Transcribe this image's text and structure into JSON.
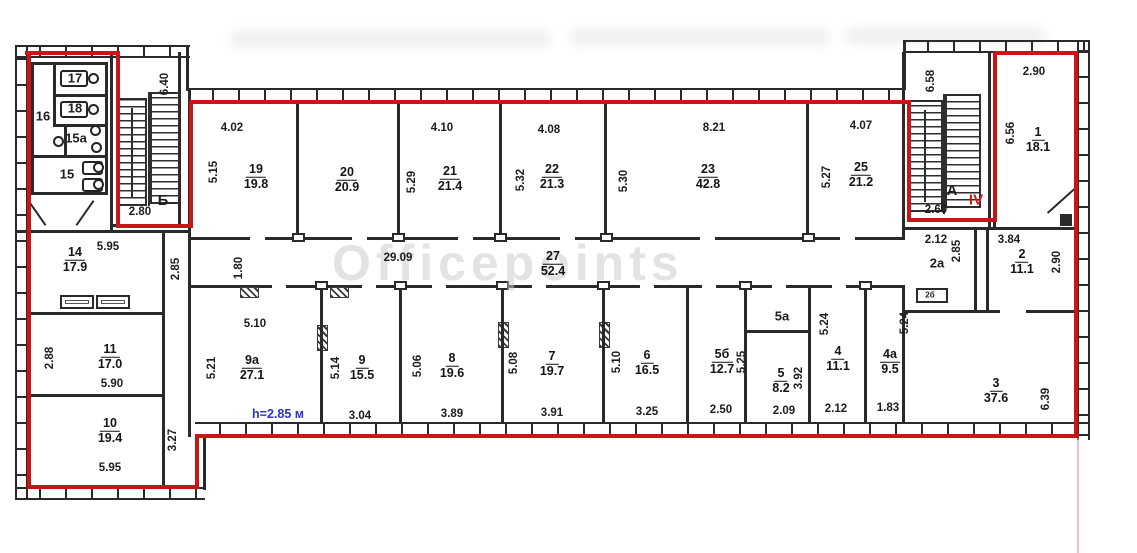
{
  "watermark": "Officepoints",
  "colors": {
    "boundary": "#c81616",
    "wall": "#2a2a2a",
    "height_note": "#2d35c0",
    "section_mark": "#cc1d1d"
  },
  "frac_labels": [
    {
      "num": "19",
      "area": "19.8",
      "x": 256,
      "y": 177
    },
    {
      "num": "20",
      "area": "20.9",
      "x": 347,
      "y": 180
    },
    {
      "num": "21",
      "area": "21.4",
      "x": 450,
      "y": 179
    },
    {
      "num": "22",
      "area": "21.3",
      "x": 552,
      "y": 177
    },
    {
      "num": "23",
      "area": "42.8",
      "x": 708,
      "y": 177
    },
    {
      "num": "25",
      "area": "21.2",
      "x": 861,
      "y": 175
    },
    {
      "num": "27",
      "area": "52.4",
      "x": 553,
      "y": 264
    },
    {
      "num": "9а",
      "area": "27.1",
      "x": 252,
      "y": 368
    },
    {
      "num": "9",
      "area": "15.5",
      "x": 362,
      "y": 368
    },
    {
      "num": "8",
      "area": "19.6",
      "x": 452,
      "y": 366
    },
    {
      "num": "7",
      "area": "19.7",
      "x": 552,
      "y": 364
    },
    {
      "num": "6",
      "area": "16.5",
      "x": 647,
      "y": 363
    },
    {
      "num": "5б",
      "area": "12.7",
      "x": 722,
      "y": 362
    },
    {
      "num": "5",
      "area": "8.2",
      "x": 781,
      "y": 381
    },
    {
      "num": "4",
      "area": "11.1",
      "x": 838,
      "y": 359
    },
    {
      "num": "4а",
      "area": "9.5",
      "x": 890,
      "y": 362
    },
    {
      "num": "1",
      "area": "18.1",
      "x": 1038,
      "y": 140
    },
    {
      "num": "2",
      "area": "11.1",
      "x": 1022,
      "y": 262
    },
    {
      "num": "3",
      "area": "37.6",
      "x": 996,
      "y": 391
    },
    {
      "num": "14",
      "area": "17.9",
      "x": 75,
      "y": 260
    },
    {
      "num": "11",
      "area": "17.0",
      "x": 110,
      "y": 357
    },
    {
      "num": "10",
      "area": "19.4",
      "x": 110,
      "y": 431
    }
  ],
  "text_labels": [
    {
      "t": "4.02",
      "x": 232,
      "y": 128,
      "cls": ""
    },
    {
      "t": "4.10",
      "x": 442,
      "y": 128,
      "cls": ""
    },
    {
      "t": "4.08",
      "x": 549,
      "y": 130,
      "cls": ""
    },
    {
      "t": "8.21",
      "x": 714,
      "y": 128,
      "cls": ""
    },
    {
      "t": "4.07",
      "x": 861,
      "y": 126,
      "cls": ""
    },
    {
      "t": "2.90",
      "x": 1034,
      "y": 72,
      "cls": ""
    },
    {
      "t": "5.15",
      "x": 214,
      "y": 172,
      "cls": "rot"
    },
    {
      "t": "5.29",
      "x": 412,
      "y": 182,
      "cls": "rot"
    },
    {
      "t": "5.32",
      "x": 521,
      "y": 180,
      "cls": "rot"
    },
    {
      "t": "5.30",
      "x": 624,
      "y": 181,
      "cls": "rot"
    },
    {
      "t": "5.27",
      "x": 827,
      "y": 177,
      "cls": "rot"
    },
    {
      "t": "6.58",
      "x": 931,
      "y": 81,
      "cls": "rot"
    },
    {
      "t": "6.56",
      "x": 1011,
      "y": 133,
      "cls": "rot"
    },
    {
      "t": "6.40",
      "x": 165,
      "y": 84,
      "cls": "rot"
    },
    {
      "t": "2.80",
      "x": 140,
      "y": 212,
      "cls": ""
    },
    {
      "t": "2.60",
      "x": 936,
      "y": 210,
      "cls": ""
    },
    {
      "t": "29.09",
      "x": 398,
      "y": 258,
      "cls": ""
    },
    {
      "t": "1.80",
      "x": 239,
      "y": 268,
      "cls": "rot"
    },
    {
      "t": "2.85",
      "x": 176,
      "y": 269,
      "cls": "rot"
    },
    {
      "t": "5.95",
      "x": 108,
      "y": 247,
      "cls": ""
    },
    {
      "t": "2.88",
      "x": 50,
      "y": 358,
      "cls": "rot"
    },
    {
      "t": "5.90",
      "x": 112,
      "y": 384,
      "cls": ""
    },
    {
      "t": "3.27",
      "x": 173,
      "y": 440,
      "cls": "rot"
    },
    {
      "t": "5.95",
      "x": 110,
      "y": 468,
      "cls": ""
    },
    {
      "t": "5.10",
      "x": 255,
      "y": 324,
      "cls": ""
    },
    {
      "t": "5.21",
      "x": 212,
      "y": 368,
      "cls": "rot"
    },
    {
      "t": "5.14",
      "x": 336,
      "y": 368,
      "cls": "rot"
    },
    {
      "t": "3.04",
      "x": 360,
      "y": 416,
      "cls": ""
    },
    {
      "t": "5.06",
      "x": 418,
      "y": 366,
      "cls": "rot"
    },
    {
      "t": "3.89",
      "x": 452,
      "y": 414,
      "cls": ""
    },
    {
      "t": "5.08",
      "x": 514,
      "y": 363,
      "cls": "rot"
    },
    {
      "t": "3.91",
      "x": 552,
      "y": 413,
      "cls": ""
    },
    {
      "t": "5.10",
      "x": 617,
      "y": 362,
      "cls": "rot"
    },
    {
      "t": "3.25",
      "x": 647,
      "y": 412,
      "cls": ""
    },
    {
      "t": "5.25",
      "x": 742,
      "y": 362,
      "cls": "rot"
    },
    {
      "t": "2.50",
      "x": 721,
      "y": 410,
      "cls": ""
    },
    {
      "t": "5а",
      "x": 782,
      "y": 316,
      "cls": "roomtx"
    },
    {
      "t": "3.92",
      "x": 799,
      "y": 378,
      "cls": "rot"
    },
    {
      "t": "2.09",
      "x": 784,
      "y": 411,
      "cls": ""
    },
    {
      "t": "5.24",
      "x": 825,
      "y": 324,
      "cls": "rot"
    },
    {
      "t": "2.12",
      "x": 836,
      "y": 409,
      "cls": ""
    },
    {
      "t": "5.24",
      "x": 905,
      "y": 323,
      "cls": "rot"
    },
    {
      "t": "1.83",
      "x": 888,
      "y": 408,
      "cls": ""
    },
    {
      "t": "2.12",
      "x": 936,
      "y": 240,
      "cls": ""
    },
    {
      "t": "2.85",
      "x": 957,
      "y": 251,
      "cls": "rot"
    },
    {
      "t": "3.84",
      "x": 1009,
      "y": 240,
      "cls": ""
    },
    {
      "t": "2.90",
      "x": 1057,
      "y": 262,
      "cls": "rot"
    },
    {
      "t": "6.39",
      "x": 1046,
      "y": 399,
      "cls": "rot"
    },
    {
      "t": "17",
      "x": 75,
      "y": 78,
      "cls": "roomtx"
    },
    {
      "t": "18",
      "x": 75,
      "y": 108,
      "cls": "roomtx"
    },
    {
      "t": "16",
      "x": 43,
      "y": 116,
      "cls": "roomtx"
    },
    {
      "t": "15а",
      "x": 76,
      "y": 138,
      "cls": "roomtx"
    },
    {
      "t": "15",
      "x": 67,
      "y": 174,
      "cls": "roomtx"
    },
    {
      "t": "2а",
      "x": 937,
      "y": 263,
      "cls": "roomtx"
    },
    {
      "t": "2б",
      "x": 930,
      "y": 295,
      "cls": "tiny"
    },
    {
      "t": "А",
      "x": 952,
      "y": 191,
      "cls": "roomtx big"
    },
    {
      "t": "Б",
      "x": 163,
      "y": 201,
      "cls": "roomtx big"
    },
    {
      "t": "IV",
      "x": 976,
      "y": 200,
      "cls": "redtx"
    },
    {
      "t": "h=2.85 м",
      "x": 278,
      "y": 414,
      "cls": "blue"
    }
  ]
}
